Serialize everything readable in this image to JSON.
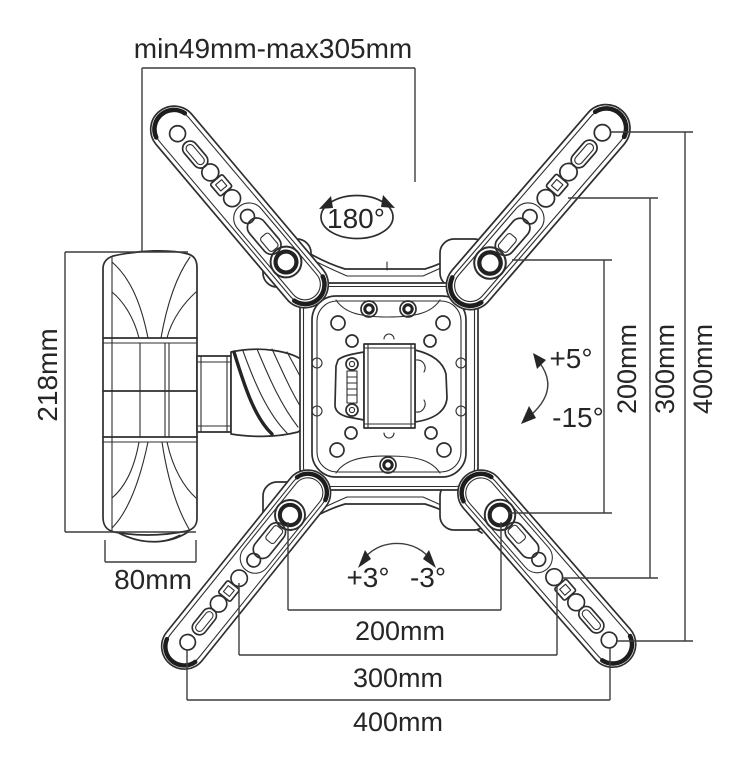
{
  "annotations": {
    "extension_range": "min49mm-max305mm",
    "swivel": "180°",
    "bracket_height": "218mm",
    "wall_plate_depth": "80mm",
    "tilt_up": "+5°",
    "tilt_down": "-15°",
    "roll_left": "+3°",
    "roll_right": "-3°"
  },
  "vesa": {
    "vertical": [
      "200mm",
      "300mm",
      "400mm"
    ],
    "horizontal": [
      "200mm",
      "300mm",
      "400mm"
    ]
  },
  "colors": {
    "line": "#2e2e2e",
    "dimension": "#3d3d3d",
    "background": "#ffffff"
  }
}
